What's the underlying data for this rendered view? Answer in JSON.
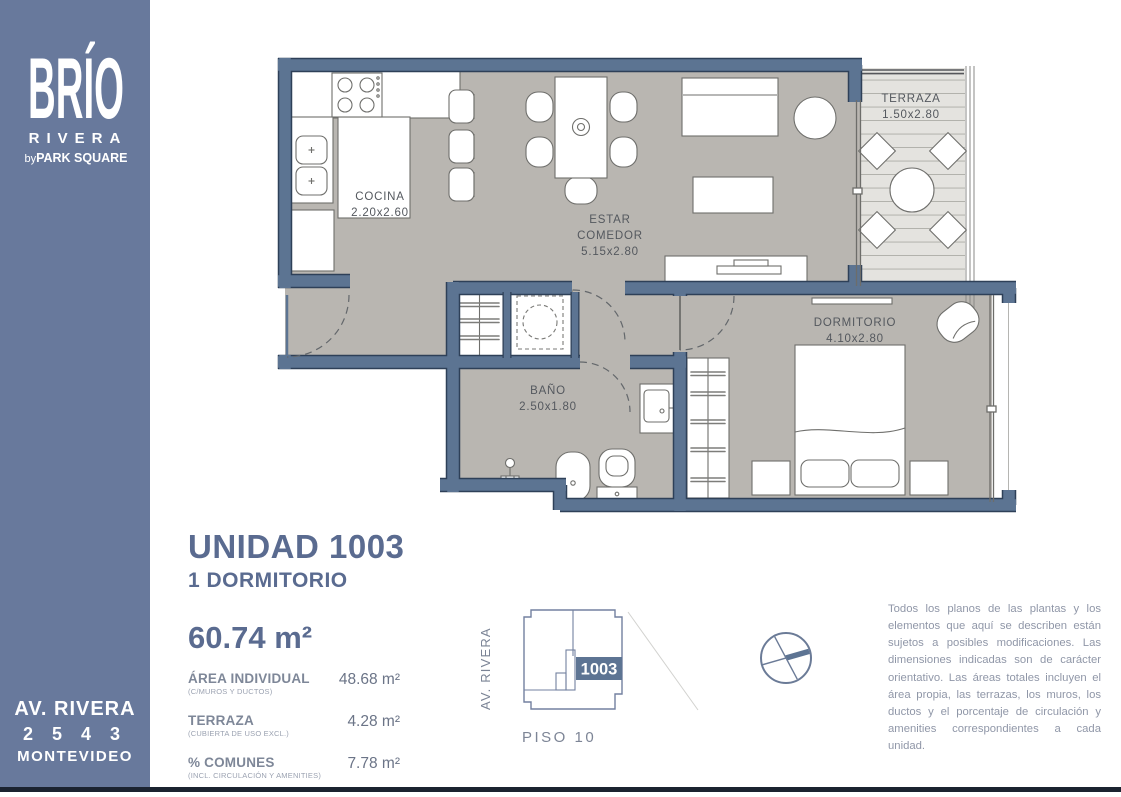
{
  "sidebar": {
    "brand": "BRÍO",
    "project": "RIVERA",
    "by": "by",
    "company": "PARK SQUARE",
    "address_line1": "AV. RIVERA",
    "address_line2": "2 5 4 3",
    "address_line3": "MONTEVIDEO"
  },
  "plan": {
    "rooms": {
      "cocina": {
        "name": "COCINA",
        "dims": "2.20x2.60"
      },
      "estar": {
        "name_line1": "ESTAR",
        "name_line2": "COMEDOR",
        "dims": "5.15x2.80"
      },
      "terraza": {
        "name": "TERRAZA",
        "dims": "1.50x2.80"
      },
      "dormitorio": {
        "name": "DORMITORIO",
        "dims": "4.10x2.80"
      },
      "bano": {
        "name": "BAÑO",
        "dims": "2.50x1.80"
      }
    }
  },
  "unit": {
    "title": "UNIDAD 1003",
    "subtitle": "1 DORMITORIO",
    "total_area": "60.74 m²",
    "rows": [
      {
        "label": "ÁREA INDIVIDUAL",
        "sublabel": "(C/MUROS Y DUCTOS)",
        "value": "48.68 m²"
      },
      {
        "label": "TERRAZA",
        "sublabel": "(CUBIERTA DE USO EXCL.)",
        "value": "4.28 m²"
      },
      {
        "label": "% COMUNES",
        "sublabel": "(INCL. CIRCULACIÓN Y AMENITIES)",
        "value": "7.78 m²"
      }
    ]
  },
  "keyplan": {
    "street": "AV. RIVERA",
    "unit": "1003",
    "floor": "PISO 10"
  },
  "disclaimer": "Todos los planos de las plantas y los elementos que aquí se describen están sujetos a posibles modificaciones. Las dimensiones indicadas son de carácter orientativo. Las áreas totales incluyen el área propia, las terrazas, los muros, los ductos y el porcentaje de circulación y amenities correspondientes a cada unidad.",
  "colors": {
    "sidebar": "#68799C",
    "wall": "#5C7492",
    "wall_outline": "#2E4058",
    "floor": "#B9B6B1",
    "deck": "#E4E3DF",
    "accent": "#5D7493",
    "title": "#5A6B90"
  }
}
